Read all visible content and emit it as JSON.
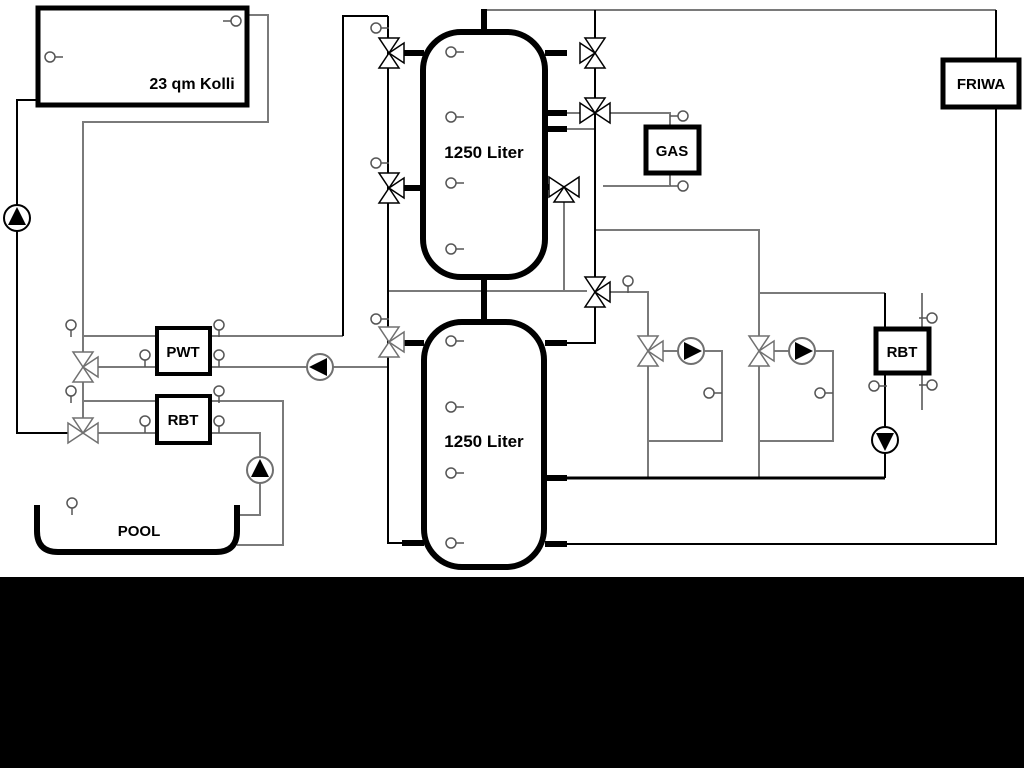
{
  "diagram": {
    "collector": {
      "label": "23 qm Kolli"
    },
    "tank_top": {
      "label": "1250 Liter"
    },
    "tank_bottom": {
      "label": "1250 Liter"
    },
    "pwt": {
      "label": "PWT"
    },
    "rbt_left": {
      "label": "RBT"
    },
    "rbt_right": {
      "label": "RBT"
    },
    "gas": {
      "label": "GAS"
    },
    "friwa": {
      "label": "FRIWA"
    },
    "pool": {
      "label": "POOL"
    },
    "colors": {
      "pipe_gray": "#7a7a7a",
      "pipe_black": "#000000",
      "component_gray": "#707070",
      "sensor_gray": "#555555",
      "background": "#ffffff",
      "bottom_band": "#000000"
    }
  }
}
